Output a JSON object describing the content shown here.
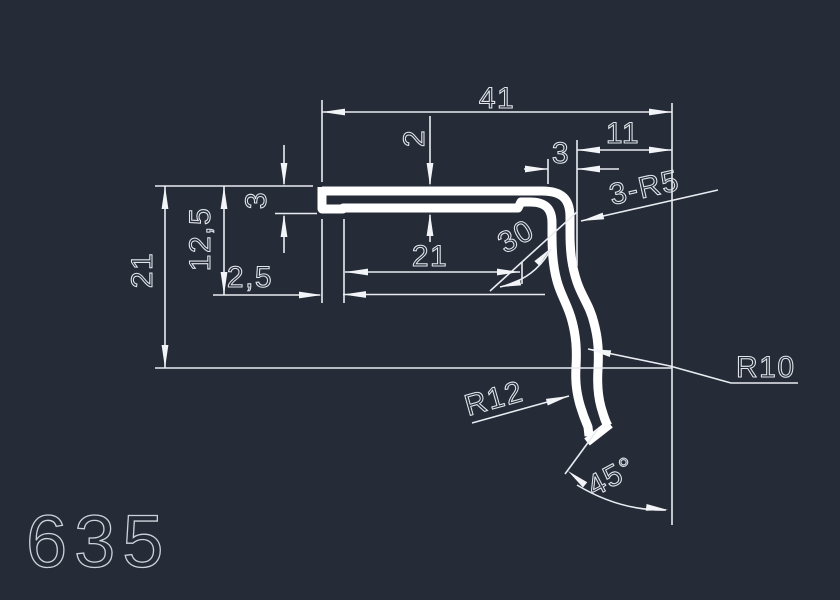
{
  "app": {
    "type": "cad-drawing-viewport",
    "background_color": "#252b37",
    "profile_line_color": "#ffffff",
    "dimension_color": "#e9ecf1",
    "part_number_color": "#cdd2da"
  },
  "drawing": {
    "part_number": "635",
    "dimensions": {
      "overall_width": "41",
      "wall_thickness": "2",
      "top_right_offset": "11",
      "corner_offset": "3",
      "corner_radius_note": "3-R5",
      "overall_height": "21",
      "lip_drop": "12,5",
      "lip_height": "3",
      "lip_width": "2,5",
      "inner_width": "21",
      "bend_angle": "30",
      "outer_radius": "R10",
      "inner_radius": "R12",
      "end_cut_angle": "45°"
    }
  }
}
